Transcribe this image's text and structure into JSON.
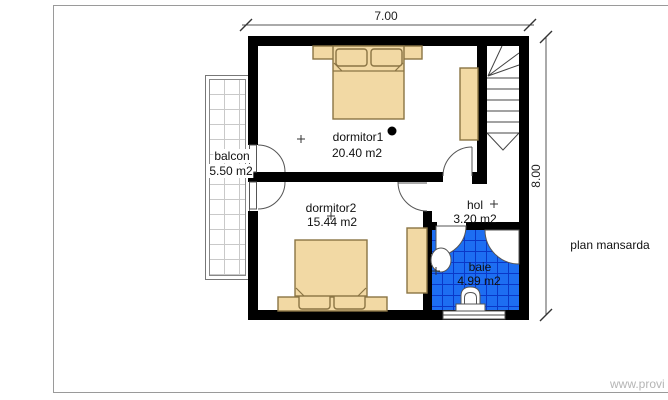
{
  "title": "plan mansarda",
  "watermark": "www.provi",
  "dimensions": {
    "width": "7.00",
    "height": "8.00"
  },
  "rooms": [
    {
      "name": "dormitor1",
      "area": "20.40 m2"
    },
    {
      "name": "dormitor2",
      "area": "15.44 m2"
    },
    {
      "name": "hol",
      "area": "3.20 m2"
    },
    {
      "name": "baie",
      "area": "4.99 m2"
    },
    {
      "name": "balcon",
      "area": "5.50 m2"
    }
  ],
  "colors": {
    "wall": "#000000",
    "furniture": "#f2d9a4",
    "furniture-border": "#8a7444",
    "tile": "#1d6ef2",
    "tile-grid": "#0a38c8",
    "line": "#555555",
    "watermark": "#b5b5b5",
    "frame": "#9a9a9a"
  }
}
